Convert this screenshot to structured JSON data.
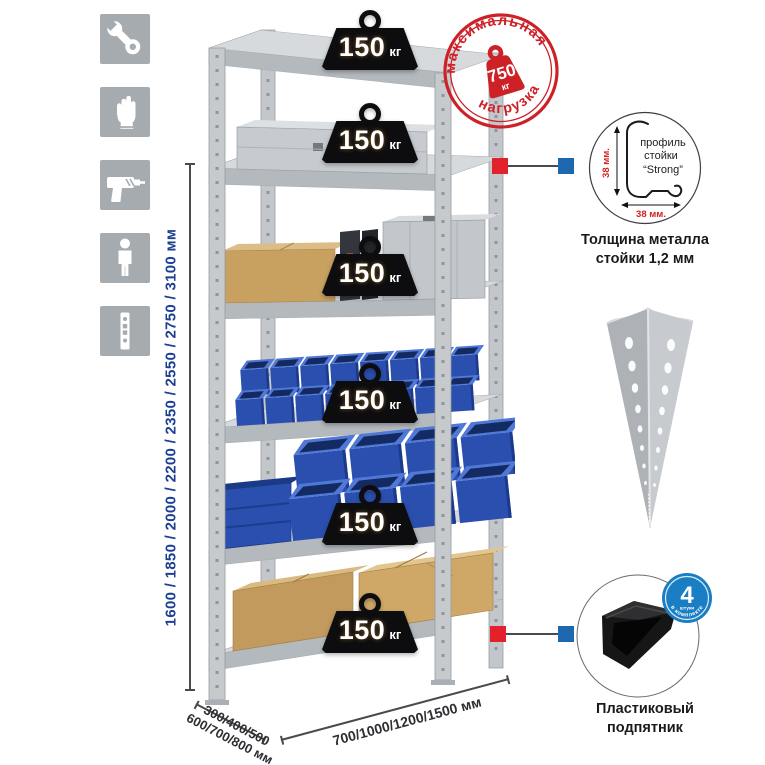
{
  "colors": {
    "icon_square": "#a6abb0",
    "dimension_height_text": "#1d3f94",
    "dimension_bottom_text": "#2e2f33",
    "stamp_red": "#cd2127",
    "connector_red": "#e3212a",
    "connector_blue": "#1e68b2",
    "bin_blue": "#2a4fae",
    "cardboard": "#c8a161",
    "steel_gray": "#c6cacd",
    "badge_black": "#0d0d0f",
    "foot_badge_blue": "#1a7ec4"
  },
  "sidebar": {
    "items": [
      {
        "icon": "wrench-icon"
      },
      {
        "icon": "gloves-icon"
      },
      {
        "icon": "drill-icon"
      },
      {
        "icon": "person-icon"
      },
      {
        "icon": "rack-post-icon"
      }
    ]
  },
  "dimensions": {
    "height_label": "1600 / 1850 / 2000 / 2200 / 2350 / 2550 / 2750 / 3100 мм",
    "depth_label_line1": "300/400/500",
    "depth_label_line2": "600/700/800 мм",
    "width_label": "700/1000/1200/1500 мм"
  },
  "rack": {
    "badges": [
      {
        "value": "150",
        "unit": "кг"
      },
      {
        "value": "150",
        "unit": "кг"
      },
      {
        "value": "150",
        "unit": "кг"
      },
      {
        "value": "150",
        "unit": "кг"
      },
      {
        "value": "150",
        "unit": "кг"
      },
      {
        "value": "150",
        "unit": "кг"
      }
    ]
  },
  "stamp": {
    "arc_top": "максимальная",
    "arc_bottom": "нагрузка",
    "weight_value": "750",
    "weight_unit": "кг"
  },
  "profile_detail": {
    "label_line1": "профиль",
    "label_line2": "стойки",
    "label_line3": "“Strong”",
    "dim_vertical": "38 мм.",
    "dim_horizontal": "38 мм.",
    "caption_line1": "Толщина металла",
    "caption_line2": "стойки 1,2 мм"
  },
  "foot_detail": {
    "badge_value": "4",
    "badge_sub": "штуки",
    "badge_arc": "в комплекте",
    "caption_line1": "Пластиковый",
    "caption_line2": "подпятник"
  }
}
